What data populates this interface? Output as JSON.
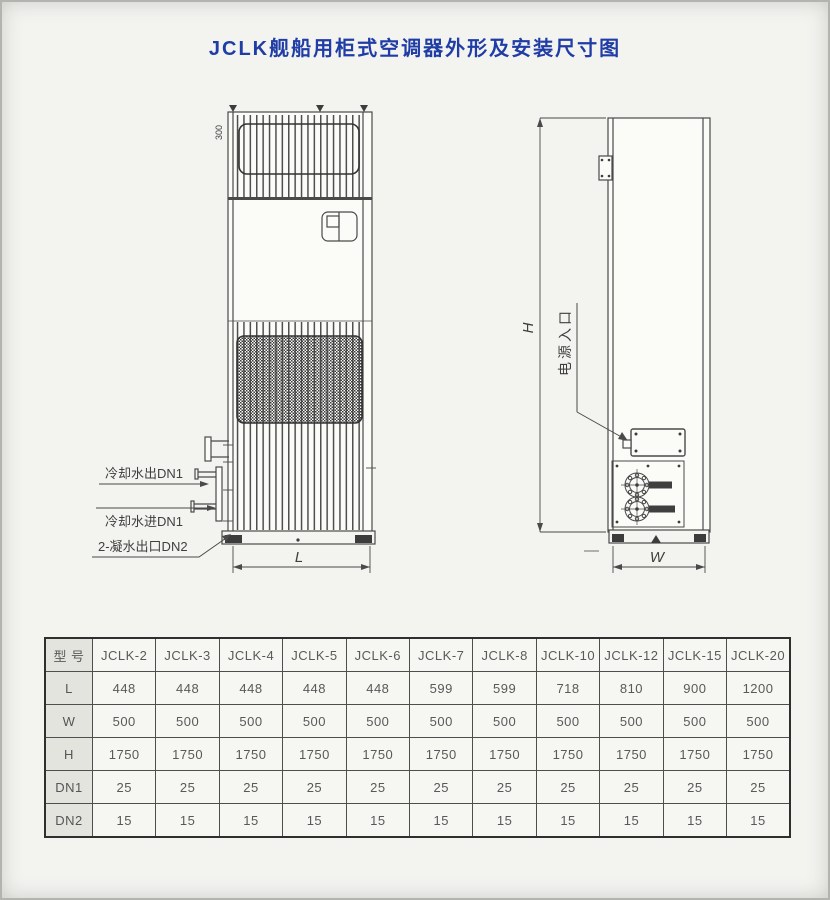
{
  "page": {
    "title": "JCLK舰船用柜式空调器外形及安装尺寸图"
  },
  "colors": {
    "title_blue": "#203da6",
    "line_gray": "#4a4a4a",
    "table_text_gray": "#595959"
  },
  "front_view": {
    "callout_water_out": "冷却水出DN1",
    "callout_water_in": "冷却水进DN1",
    "callout_condensate": "2-凝水出口DN2",
    "dim_length": "L",
    "top_note": "300"
  },
  "side_view": {
    "power_inlet": "电源入口",
    "dim_height": "H",
    "dim_width": "W"
  },
  "table": {
    "model_header": "型 号",
    "columns": [
      "JCLK-2",
      "JCLK-3",
      "JCLK-4",
      "JCLK-5",
      "JCLK-6",
      "JCLK-7",
      "JCLK-8",
      "JCLK-10",
      "JCLK-12",
      "JCLK-15",
      "JCLK-20"
    ],
    "rows": [
      {
        "label": "L",
        "values": [
          "448",
          "448",
          "448",
          "448",
          "448",
          "599",
          "599",
          "718",
          "810",
          "900",
          "1200"
        ]
      },
      {
        "label": "W",
        "values": [
          "500",
          "500",
          "500",
          "500",
          "500",
          "500",
          "500",
          "500",
          "500",
          "500",
          "500"
        ]
      },
      {
        "label": "H",
        "values": [
          "1750",
          "1750",
          "1750",
          "1750",
          "1750",
          "1750",
          "1750",
          "1750",
          "1750",
          "1750",
          "1750"
        ]
      },
      {
        "label": "DN1",
        "values": [
          "25",
          "25",
          "25",
          "25",
          "25",
          "25",
          "25",
          "25",
          "25",
          "25",
          "25"
        ]
      },
      {
        "label": "DN2",
        "values": [
          "15",
          "15",
          "15",
          "15",
          "15",
          "15",
          "15",
          "15",
          "15",
          "15",
          "15"
        ]
      }
    ]
  }
}
